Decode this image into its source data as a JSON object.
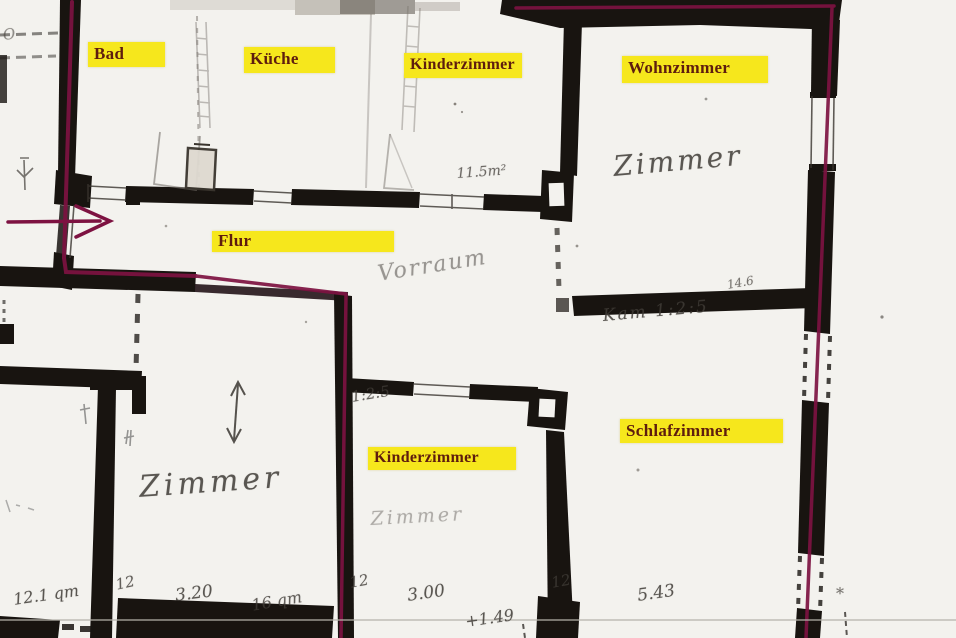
{
  "colors": {
    "paper": "#f3f2ee",
    "wall_black": "#181410",
    "boundary_maroon": "#7d1241",
    "highlight_yellow": "#f6e71c",
    "label_text": "#5e1d0e",
    "pencil_gray": "#6e6a66"
  },
  "room_labels": [
    {
      "id": "bad",
      "text": "Bad"
    },
    {
      "id": "kueche",
      "text": "Küche"
    },
    {
      "id": "kinderzimmer-top",
      "text": "Kinderzimmer"
    },
    {
      "id": "wohnzimmer",
      "text": "Wohnzimmer"
    },
    {
      "id": "flur",
      "text": "Flur"
    },
    {
      "id": "kinderzimmer-bottom",
      "text": "Kinderzimmer"
    },
    {
      "id": "schlafzimmer",
      "text": "Schlafzimmer"
    }
  ],
  "annotations": [
    {
      "id": "mark-o-top-left",
      "text": "O"
    },
    {
      "id": "area-11-5",
      "text": "11.5m²"
    },
    {
      "id": "zimmer-wohn",
      "text": "Zimmer"
    },
    {
      "id": "dim-14-6",
      "text": "14.6"
    },
    {
      "id": "kam-1-2-5",
      "text": "Kam 1:2:5"
    },
    {
      "id": "vorraum",
      "text": "Vorraum"
    },
    {
      "id": "ratio-1-2-5",
      "text": "1:2:5"
    },
    {
      "id": "zimmer-left",
      "text": "Zimmer"
    },
    {
      "id": "zimmer-faint",
      "text": "Zimmer"
    },
    {
      "id": "dim-12-a",
      "text": "12"
    },
    {
      "id": "area-12-1-qm",
      "text": "12.1 qm"
    },
    {
      "id": "dim-3-20",
      "text": "3.20"
    },
    {
      "id": "area-16-qm",
      "text": "16 qm"
    },
    {
      "id": "dim-12-b",
      "text": "12"
    },
    {
      "id": "dim-3-00",
      "text": "3.00"
    },
    {
      "id": "dim-1-49",
      "text": "+1.49"
    },
    {
      "id": "dim-12-c",
      "text": "12"
    },
    {
      "id": "dim-5-43",
      "text": "5.43"
    },
    {
      "id": "mark-star",
      "text": "*"
    }
  ]
}
